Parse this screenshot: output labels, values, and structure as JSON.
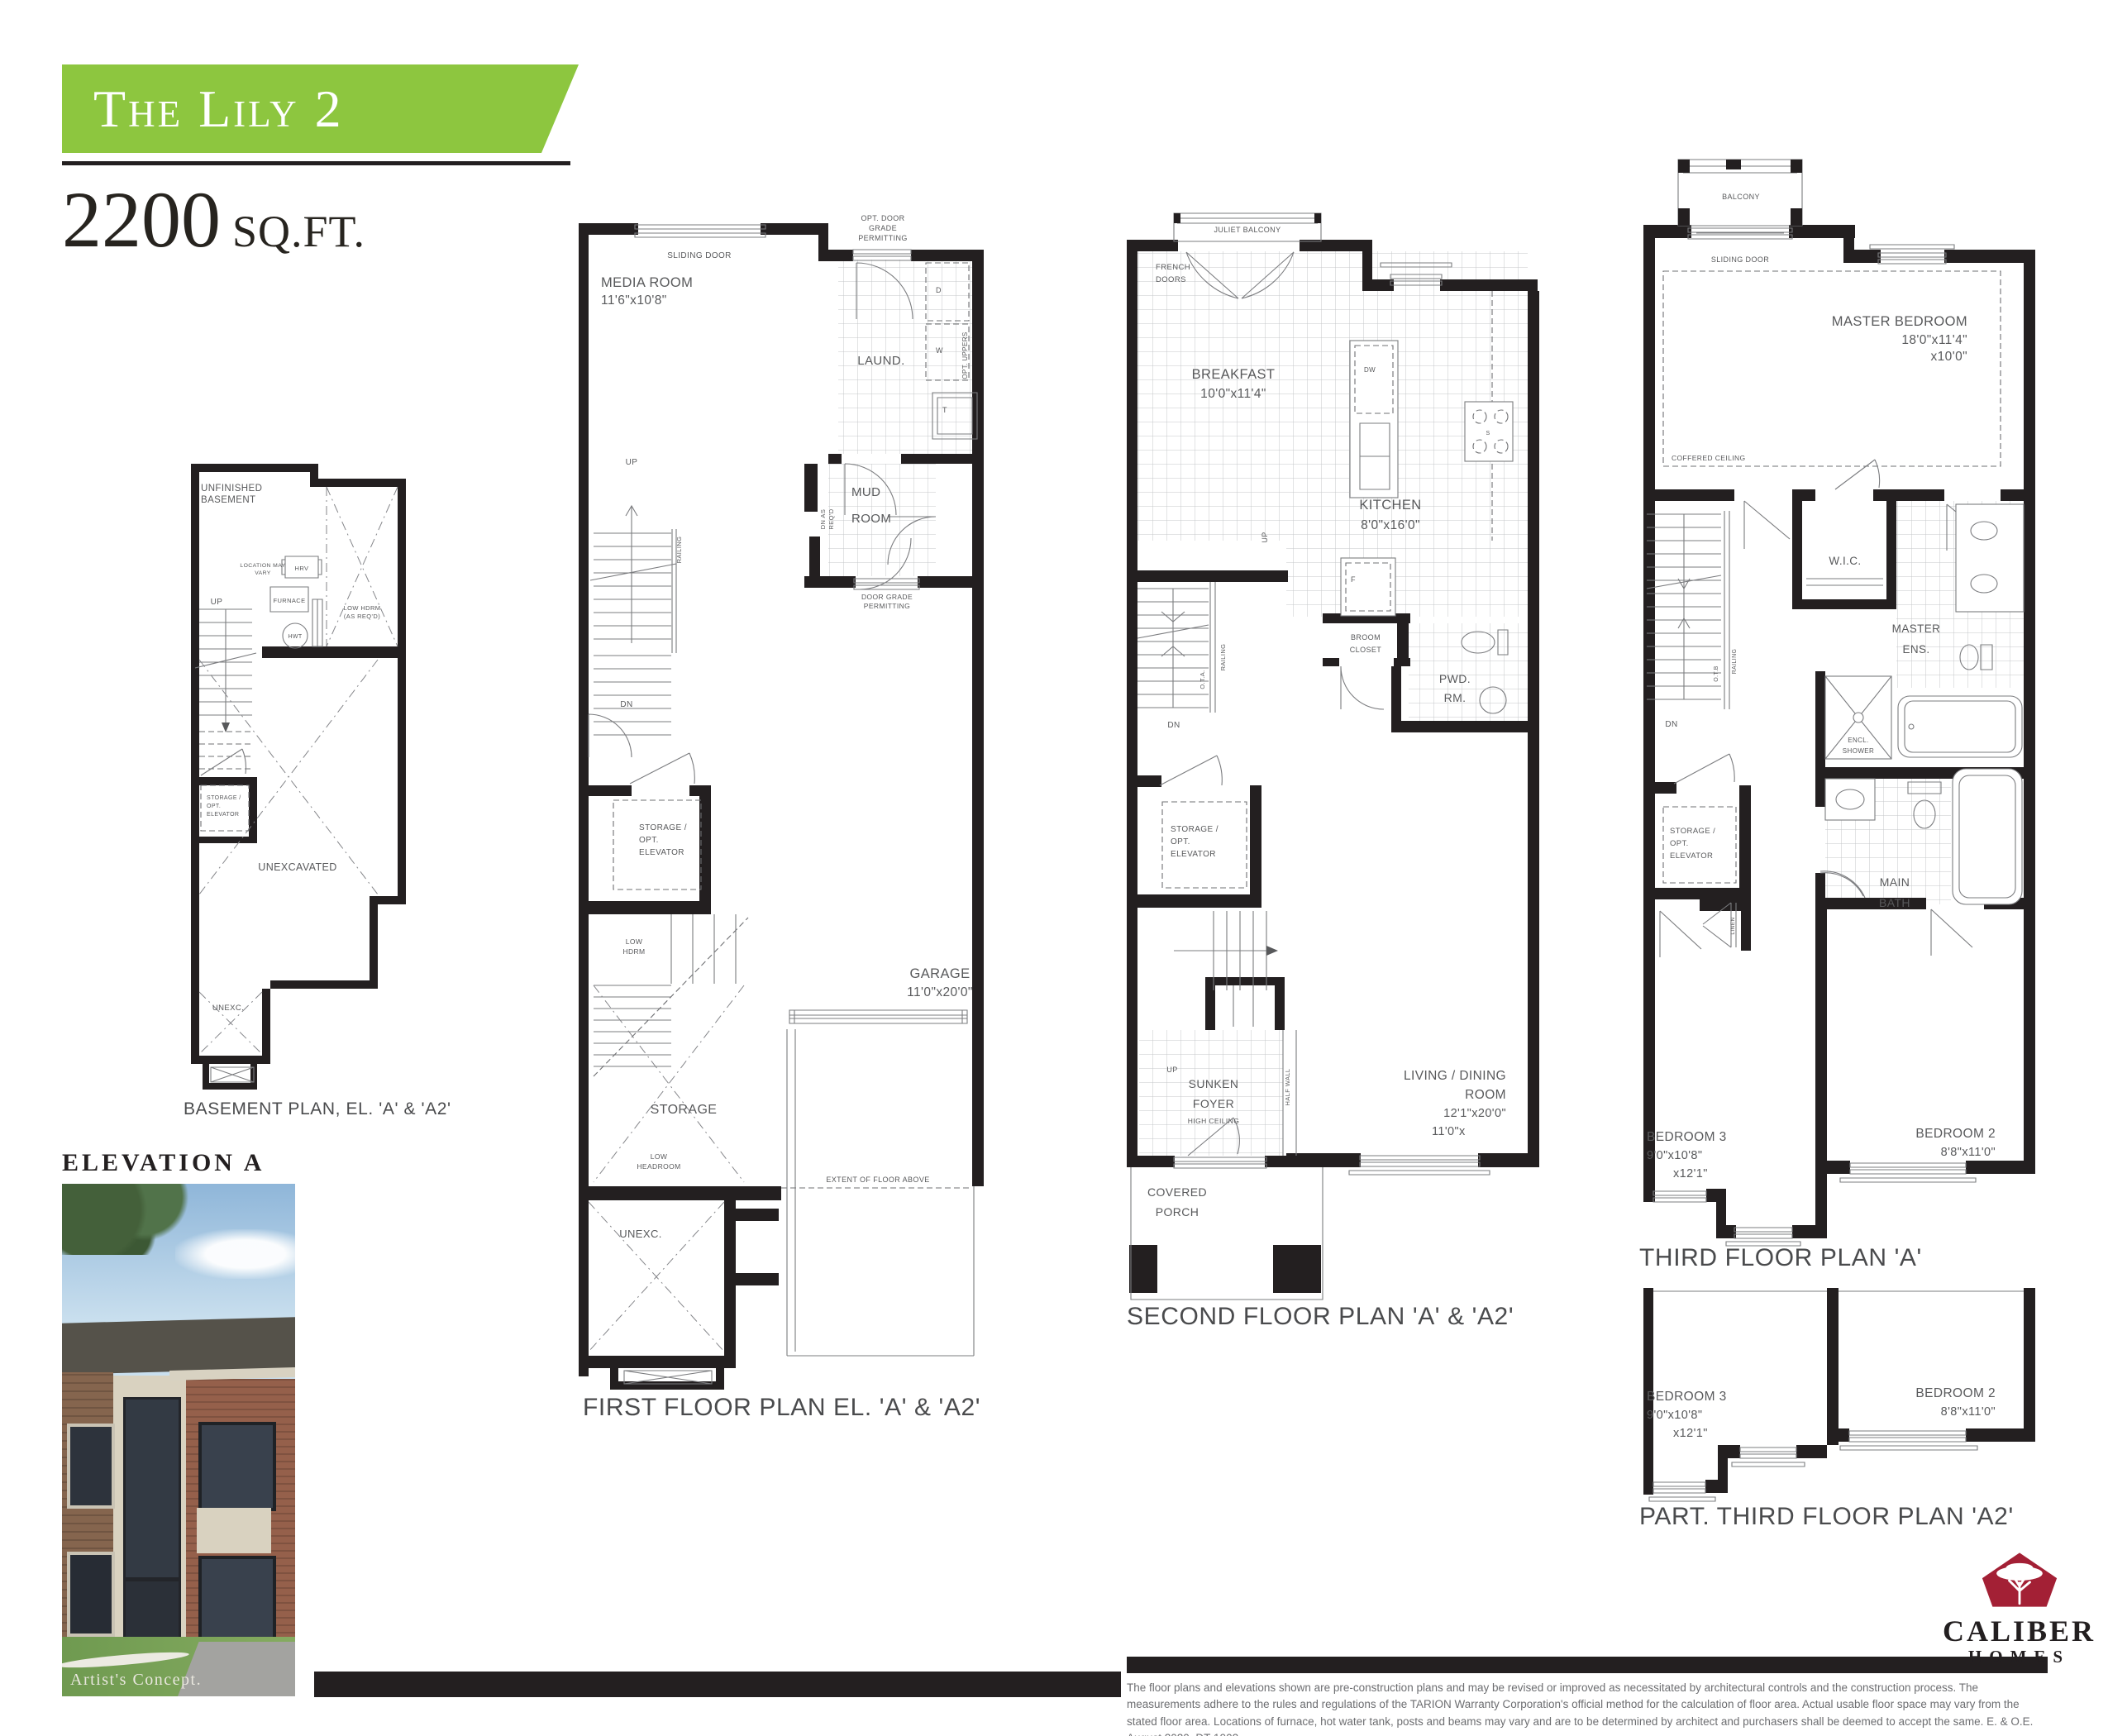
{
  "header": {
    "model_name": "The Lily 2",
    "sqft_value": "2200",
    "sqft_unit": "SQ.FT.",
    "banner_color": "#8dc63f"
  },
  "elevation": {
    "heading": "ELEVATION A",
    "caption": "Artist's Concept."
  },
  "common": {
    "up": "UP",
    "dn": "DN",
    "railing": "RAILING",
    "storage_l1": "STORAGE /",
    "storage_l2": "OPT.",
    "storage_l3": "ELEVATOR",
    "sliding_door": "SLIDING DOOR",
    "unexc": "UNEXC."
  },
  "basement": {
    "caption": "BASEMENT PLAN, EL. 'A' & 'A2'",
    "room_l1": "UNFINISHED",
    "room_l2": "BASEMENT",
    "location_l1": "LOCATION MAY",
    "location_l2": "VARY",
    "hrv": "HRV",
    "furnace": "FURNACE",
    "hwt": "HWT",
    "lowhdrm_l1": "LOW HDRM",
    "lowhdrm_l2": "(AS REQ'D)",
    "unexcavated": "UNEXCAVATED"
  },
  "first": {
    "caption": "FIRST FLOOR PLAN EL. 'A' & 'A2'",
    "opt_door_l1": "OPT. DOOR",
    "opt_door_l2": "GRADE",
    "opt_door_l3": "PERMITTING",
    "media_room": "MEDIA ROOM",
    "media_dims": "11'6\"x10'8\"",
    "laundry": "LAUND.",
    "dryer": "D",
    "washer": "W",
    "tub": "T",
    "opt_uppers": "OPT. UPPERS",
    "mud_l1": "MUD",
    "mud_l2": "ROOM",
    "dn_as_req_l1": "DN AS",
    "dn_as_req_l2": "REQ'D",
    "door_grade_l1": "DOOR GRADE",
    "door_grade_l2": "PERMITTING",
    "low_hdrm_l1": "LOW",
    "low_hdrm_l2": "HDRM",
    "garage": "GARAGE",
    "garage_dims": "11'0\"x20'0\"",
    "storage": "STORAGE",
    "low_headroom_l1": "LOW",
    "low_headroom_l2": "HEADROOM",
    "extent": "EXTENT OF FLOOR ABOVE"
  },
  "second": {
    "caption": "SECOND FLOOR PLAN 'A' & 'A2'",
    "juliet_balcony": "JULIET BALCONY",
    "french_l1": "FRENCH",
    "french_l2": "DOORS",
    "breakfast": "BREAKFAST",
    "breakfast_dims": "10'0\"x11'4\"",
    "dw": "DW",
    "kitchen": "KITCHEN",
    "kitchen_dims": "8'0\"x16'0\"",
    "fridge": "F",
    "stove": "S",
    "ota": "O.T.A.",
    "broom_l1": "BROOM",
    "broom_l2": "CLOSET",
    "pwd_l1": "PWD.",
    "pwd_l2": "RM.",
    "sunken_l1": "SUNKEN",
    "sunken_l2": "FOYER",
    "high_ceiling": "HIGH CEILING",
    "half_wall": "HALF WALL",
    "living_l1": "LIVING / DINING",
    "living_l2": "ROOM",
    "living_dims1": "12'1\"x20'0\"",
    "living_dims2": "11'0\"x",
    "porch_l1": "COVERED",
    "porch_l2": "PORCH"
  },
  "third": {
    "caption": "THIRD FLOOR PLAN 'A'",
    "balcony": "BALCONY",
    "master": "MASTER BEDROOM",
    "master_dims1": "18'0\"x11'4\"",
    "master_dims2": "x10'0\"",
    "coffered": "COFFERED CEILING",
    "wic": "W.I.C.",
    "ens_l1": "MASTER",
    "ens_l2": "ENS.",
    "otb": "O.T.B",
    "shower_l1": "ENCL.",
    "shower_l2": "SHOWER",
    "main_l1": "MAIN",
    "main_l2": "BATH",
    "linen": "LINEN",
    "bed3": "BEDROOM 3",
    "bed3_dims1": "9'0\"x10'8\"",
    "bed3_dims2": "x12'1\"",
    "bed2": "BEDROOM 2",
    "bed2_dims": "8'8\"x11'0\""
  },
  "part_third": {
    "caption": "PART. THIRD FLOOR PLAN 'A2'",
    "bed3": "BEDROOM 3",
    "bed3_dims1": "9'0\"x10'8\"",
    "bed3_dims2": "x12'1\"",
    "bed2": "BEDROOM 2",
    "bed2_dims": "8'8\"x11'0\""
  },
  "footer": {
    "brand_name": "CALIBER",
    "brand_sub": "HOMES",
    "brand_color": "#a32035",
    "disclaimer": "The floor plans and elevations shown are pre-construction plans and may be revised or improved as necessitated by architectural controls and the construction process. The measurements adhere to the rules and regulations of the TARION Warranty Corporation's official method for the calculation of floor area. Actual usable floor space may vary from the stated floor area. Locations of furnace, hot water tank, posts and beams may vary and are to be determined by architect and purchasers shall be deemed to accept the same. E. & O.E. August 2020.  DT-1902."
  }
}
